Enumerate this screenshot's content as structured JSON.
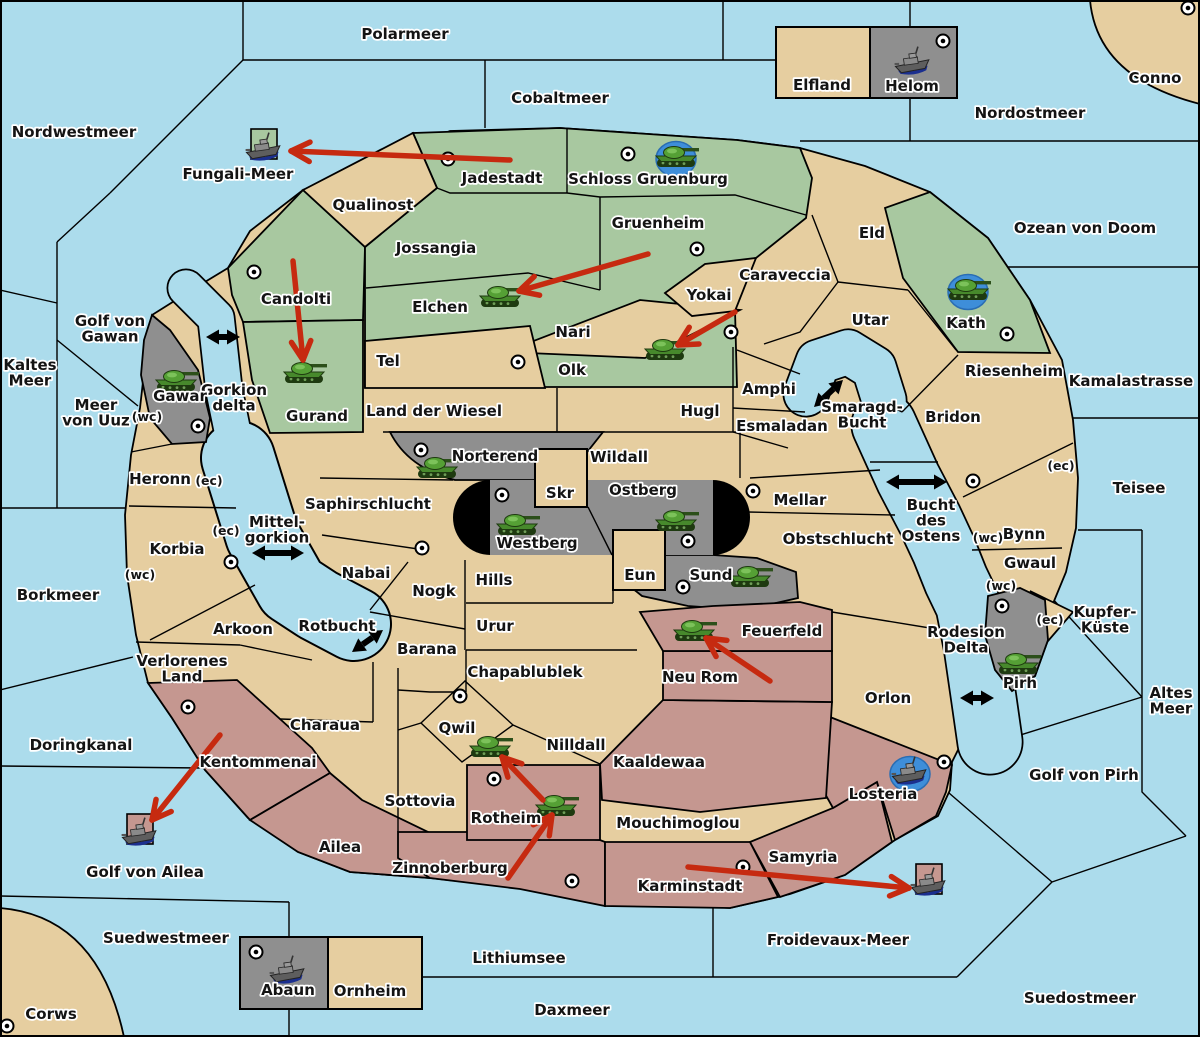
{
  "map_name": "Froidevaux wargame map",
  "palette": {
    "sea": "#ACDCEC",
    "land_tan": "#E6CEA0",
    "land_green": "#A8C8A0",
    "land_gray": "#8F8F8F",
    "land_pink": "#C59790",
    "order_red": "#C62A10",
    "unit_blue_backdrop": "#3E8ED9",
    "line_black": "#000000"
  },
  "labels": [
    {
      "id": "polarmeer",
      "text": "Polarmeer",
      "x": 405,
      "y": 39
    },
    {
      "id": "cobaltmeer",
      "text": "Cobaltmeer",
      "x": 560,
      "y": 103
    },
    {
      "id": "nordwestmeer",
      "text": "Nordwestmeer",
      "x": 74,
      "y": 137
    },
    {
      "id": "nordostmeer",
      "text": "Nordostmeer",
      "x": 1030,
      "y": 118
    },
    {
      "id": "conno",
      "text": "Conno",
      "x": 1155,
      "y": 83
    },
    {
      "id": "ozean-von-doom",
      "text": "Ozean von Doom",
      "x": 1085,
      "y": 233
    },
    {
      "id": "kamalastrasse",
      "text": "Kamalastrasse",
      "x": 1131,
      "y": 386
    },
    {
      "id": "teisee",
      "text": "Teisee",
      "x": 1139,
      "y": 493
    },
    {
      "id": "kaltes-meer",
      "lines": [
        "Kaltes",
        "Meer"
      ],
      "x": 30,
      "y": 370
    },
    {
      "id": "golf-von-gawan",
      "lines": [
        "Golf von",
        "Gawan"
      ],
      "x": 110,
      "y": 326
    },
    {
      "id": "meer-von-uuz",
      "lines": [
        "Meer",
        "von Uuz"
      ],
      "x": 96,
      "y": 410
    },
    {
      "id": "fungali-meer",
      "text": "Fungali-Meer",
      "x": 238,
      "y": 179
    },
    {
      "id": "gorkion-delta",
      "lines": [
        "Gorkion",
        "delta"
      ],
      "x": 234,
      "y": 395
    },
    {
      "id": "mittel-gorkion",
      "lines": [
        "Mittel-",
        "gorkion"
      ],
      "x": 277,
      "y": 527
    },
    {
      "id": "borkmeer",
      "text": "Borkmeer",
      "x": 58,
      "y": 600
    },
    {
      "id": "doringkanal",
      "text": "Doringkanal",
      "x": 81,
      "y": 750
    },
    {
      "id": "rotbucht",
      "text": "Rotbucht",
      "x": 337,
      "y": 631
    },
    {
      "id": "smaragd-bucht",
      "lines": [
        "Smaragd-",
        "Bucht"
      ],
      "x": 862,
      "y": 412
    },
    {
      "id": "bucht-des-ostens",
      "lines": [
        "Bucht",
        "des",
        "Ostens"
      ],
      "x": 931,
      "y": 510
    },
    {
      "id": "rodesion-delta",
      "lines": [
        "Rodesion",
        "Delta"
      ],
      "x": 966,
      "y": 637
    },
    {
      "id": "golf-von-ailea",
      "text": "Golf von Ailea",
      "x": 145,
      "y": 877
    },
    {
      "id": "suedwestmeer",
      "text": "Suedwestmeer",
      "x": 166,
      "y": 943
    },
    {
      "id": "lithiumsee",
      "text": "Lithiumsee",
      "x": 519,
      "y": 963
    },
    {
      "id": "daxmeer",
      "text": "Daxmeer",
      "x": 572,
      "y": 1015
    },
    {
      "id": "froidevaux-meer",
      "text": "Froidevaux-Meer",
      "x": 838,
      "y": 945
    },
    {
      "id": "suedostmeer",
      "text": "Suedostmeer",
      "x": 1080,
      "y": 1003
    },
    {
      "id": "golf-von-pirh",
      "text": "Golf von Pirh",
      "x": 1084,
      "y": 780
    },
    {
      "id": "altes-meer",
      "lines": [
        "Altes",
        "Meer"
      ],
      "x": 1171,
      "y": 698
    },
    {
      "id": "kupfer-kueste",
      "lines": [
        "Kupfer-",
        "Küste"
      ],
      "x": 1105,
      "y": 617
    },
    {
      "id": "corws",
      "text": "Corws",
      "x": 51,
      "y": 1019
    },
    {
      "id": "elfland",
      "text": "Elfland",
      "x": 822,
      "y": 90
    },
    {
      "id": "helom",
      "text": "Helom",
      "x": 912,
      "y": 91
    },
    {
      "id": "jadestadt",
      "text": "Jadestadt",
      "x": 502,
      "y": 183
    },
    {
      "id": "schloss-gruenburg",
      "text": "Schloss Gruenburg",
      "x": 648,
      "y": 184
    },
    {
      "id": "qualinost",
      "text": "Qualinost",
      "x": 373,
      "y": 210
    },
    {
      "id": "jossangia",
      "text": "Jossangia",
      "x": 436,
      "y": 253
    },
    {
      "id": "gruenheim",
      "text": "Gruenheim",
      "x": 658,
      "y": 228
    },
    {
      "id": "eld",
      "text": "Eld",
      "x": 872,
      "y": 238
    },
    {
      "id": "candolti",
      "text": "Candolti",
      "x": 296,
      "y": 304
    },
    {
      "id": "caraveccia",
      "text": "Caraveccia",
      "x": 785,
      "y": 280
    },
    {
      "id": "yokai",
      "text": "Yokai",
      "x": 709,
      "y": 300
    },
    {
      "id": "elchen",
      "text": "Elchen",
      "x": 440,
      "y": 312
    },
    {
      "id": "utar",
      "text": "Utar",
      "x": 870,
      "y": 325
    },
    {
      "id": "kath",
      "text": "Kath",
      "x": 966,
      "y": 328
    },
    {
      "id": "nari",
      "text": "Nari",
      "x": 573,
      "y": 337
    },
    {
      "id": "tel",
      "text": "Tel",
      "x": 388,
      "y": 366
    },
    {
      "id": "olk",
      "text": "Olk",
      "x": 572,
      "y": 375
    },
    {
      "id": "riesenheim",
      "text": "Riesenheim",
      "x": 1014,
      "y": 376
    },
    {
      "id": "gawar",
      "text": "Gawar",
      "x": 180,
      "y": 401
    },
    {
      "id": "gurand",
      "text": "Gurand",
      "x": 317,
      "y": 421
    },
    {
      "id": "land-der-wiesel",
      "text": "Land der Wiesel",
      "x": 434,
      "y": 416
    },
    {
      "id": "hugl",
      "text": "Hugl",
      "x": 700,
      "y": 416
    },
    {
      "id": "amphi",
      "text": "Amphi",
      "x": 769,
      "y": 394
    },
    {
      "id": "esmaladan",
      "text": "Esmaladan",
      "x": 782,
      "y": 431
    },
    {
      "id": "bridon",
      "text": "Bridon",
      "x": 953,
      "y": 422
    },
    {
      "id": "norterend",
      "text": "Norterend",
      "x": 495,
      "y": 461
    },
    {
      "id": "wildall",
      "text": "Wildall",
      "x": 619,
      "y": 462
    },
    {
      "id": "heronn",
      "text": "Heronn",
      "x": 160,
      "y": 484
    },
    {
      "id": "skr",
      "text": "Skr",
      "x": 560,
      "y": 498
    },
    {
      "id": "ostberg",
      "text": "Ostberg",
      "x": 643,
      "y": 495
    },
    {
      "id": "mellar",
      "text": "Mellar",
      "x": 800,
      "y": 505
    },
    {
      "id": "saphirschlucht",
      "text": "Saphirschlucht",
      "x": 368,
      "y": 509
    },
    {
      "id": "westberg",
      "text": "Westberg",
      "x": 537,
      "y": 548
    },
    {
      "id": "bynn",
      "text": "Bynn",
      "x": 1024,
      "y": 539
    },
    {
      "id": "korbia",
      "text": "Korbia",
      "x": 177,
      "y": 554
    },
    {
      "id": "obstschlucht",
      "text": "Obstschlucht",
      "x": 838,
      "y": 544
    },
    {
      "id": "nabai",
      "text": "Nabai",
      "x": 366,
      "y": 578
    },
    {
      "id": "eun",
      "text": "Eun",
      "x": 640,
      "y": 580
    },
    {
      "id": "sund",
      "text": "Sund",
      "x": 711,
      "y": 580
    },
    {
      "id": "gwaul",
      "text": "Gwaul",
      "x": 1030,
      "y": 568
    },
    {
      "id": "hills",
      "text": "Hills",
      "x": 494,
      "y": 585
    },
    {
      "id": "nogk",
      "text": "Nogk",
      "x": 434,
      "y": 596
    },
    {
      "id": "urur",
      "text": "Urur",
      "x": 495,
      "y": 631
    },
    {
      "id": "feuerfeld",
      "text": "Feuerfeld",
      "x": 782,
      "y": 636
    },
    {
      "id": "arkoon",
      "text": "Arkoon",
      "x": 243,
      "y": 634
    },
    {
      "id": "barana",
      "text": "Barana",
      "x": 427,
      "y": 654
    },
    {
      "id": "pirh",
      "text": "Pirh",
      "x": 1020,
      "y": 688
    },
    {
      "id": "verlorenes-land",
      "lines": [
        "Verlorenes",
        "Land"
      ],
      "x": 182,
      "y": 666
    },
    {
      "id": "chapablublek",
      "text": "Chapablublek",
      "x": 525,
      "y": 677
    },
    {
      "id": "neu-rom",
      "text": "Neu Rom",
      "x": 700,
      "y": 682
    },
    {
      "id": "orlon",
      "text": "Orlon",
      "x": 888,
      "y": 703
    },
    {
      "id": "charaua",
      "text": "Charaua",
      "x": 325,
      "y": 730
    },
    {
      "id": "kentommenai",
      "text": "Kentommenai",
      "x": 258,
      "y": 767
    },
    {
      "id": "qwil",
      "text": "Qwil",
      "x": 457,
      "y": 733
    },
    {
      "id": "nilldall",
      "text": "Nilldall",
      "x": 576,
      "y": 750
    },
    {
      "id": "kaaldewaa",
      "text": "Kaaldewaa",
      "x": 659,
      "y": 767
    },
    {
      "id": "losteria",
      "text": "Losteria",
      "x": 883,
      "y": 799
    },
    {
      "id": "sottovia",
      "text": "Sottovia",
      "x": 420,
      "y": 806
    },
    {
      "id": "rotheim",
      "text": "Rotheim",
      "x": 506,
      "y": 823
    },
    {
      "id": "mouchimoglou",
      "text": "Mouchimoglou",
      "x": 678,
      "y": 828
    },
    {
      "id": "ailea",
      "text": "Ailea",
      "x": 340,
      "y": 852
    },
    {
      "id": "zinnoberburg",
      "text": "Zinnoberburg",
      "x": 450,
      "y": 873
    },
    {
      "id": "samyria",
      "text": "Samyria",
      "x": 803,
      "y": 862
    },
    {
      "id": "karminstadt",
      "text": "Karminstadt",
      "x": 690,
      "y": 891
    },
    {
      "id": "abaun",
      "text": "Abaun",
      "x": 288,
      "y": 995
    },
    {
      "id": "ornheim",
      "text": "Ornheim",
      "x": 370,
      "y": 996
    },
    {
      "id": "uuz-wc",
      "text": "(wc)",
      "x": 147,
      "y": 421,
      "kind": "tag"
    },
    {
      "id": "heronn-ec",
      "text": "(ec)",
      "x": 209,
      "y": 485,
      "kind": "tag"
    },
    {
      "id": "korbia-ec",
      "text": "(ec)",
      "x": 226,
      "y": 535,
      "kind": "tag"
    },
    {
      "id": "korbia-wc",
      "text": "(wc)",
      "x": 140,
      "y": 579,
      "kind": "tag"
    },
    {
      "id": "bynn-ec",
      "text": "(ec)",
      "x": 1061,
      "y": 470,
      "kind": "tag"
    },
    {
      "id": "bynn-wc",
      "text": "(wc)",
      "x": 988,
      "y": 542,
      "kind": "tag"
    },
    {
      "id": "gwaul-wc",
      "text": "(wc)",
      "x": 1001,
      "y": 590,
      "kind": "tag"
    },
    {
      "id": "pirh-ec",
      "text": "(ec)",
      "x": 1050,
      "y": 624,
      "kind": "tag"
    }
  ],
  "supply_centers": [
    [
      448,
      159
    ],
    [
      628,
      154
    ],
    [
      697,
      249
    ],
    [
      254,
      272
    ],
    [
      1188,
      8
    ],
    [
      943,
      41
    ],
    [
      518,
      362
    ],
    [
      731,
      332
    ],
    [
      1007,
      334
    ],
    [
      198,
      426
    ],
    [
      421,
      450
    ],
    [
      502,
      495
    ],
    [
      688,
      541
    ],
    [
      753,
      491
    ],
    [
      683,
      587
    ],
    [
      422,
      548
    ],
    [
      231,
      562
    ],
    [
      188,
      707
    ],
    [
      973,
      481
    ],
    [
      1002,
      606
    ],
    [
      460,
      696
    ],
    [
      494,
      779
    ],
    [
      572,
      881
    ],
    [
      743,
      867
    ],
    [
      944,
      762
    ],
    [
      256,
      952
    ],
    [
      7,
      1026
    ]
  ],
  "units": [
    {
      "type": "army",
      "territory": "elchen",
      "x": 500,
      "y": 297,
      "backdrop": "none"
    },
    {
      "type": "army",
      "territory": "olk",
      "x": 665,
      "y": 350,
      "backdrop": "none"
    },
    {
      "type": "army",
      "territory": "gurand",
      "x": 304,
      "y": 373,
      "backdrop": "none"
    },
    {
      "type": "army",
      "territory": "gawar",
      "x": 176,
      "y": 381,
      "backdrop": "none"
    },
    {
      "type": "army",
      "territory": "norterend",
      "x": 437,
      "y": 468,
      "backdrop": "none"
    },
    {
      "type": "army",
      "territory": "westberg",
      "x": 517,
      "y": 525,
      "backdrop": "none"
    },
    {
      "type": "army",
      "territory": "ostberg",
      "x": 676,
      "y": 521,
      "backdrop": "none"
    },
    {
      "type": "army",
      "territory": "sund",
      "x": 750,
      "y": 577,
      "backdrop": "none"
    },
    {
      "type": "army",
      "territory": "feuerfeld",
      "x": 694,
      "y": 631,
      "backdrop": "none"
    },
    {
      "type": "army",
      "territory": "qwil",
      "x": 490,
      "y": 747,
      "backdrop": "none"
    },
    {
      "type": "army",
      "territory": "rotheim",
      "x": 556,
      "y": 806,
      "backdrop": "none"
    },
    {
      "type": "army",
      "territory": "pirh",
      "x": 1018,
      "y": 664,
      "backdrop": "none"
    },
    {
      "type": "army",
      "territory": "kath",
      "x": 968,
      "y": 290,
      "backdrop": "blue"
    },
    {
      "type": "army",
      "territory": "schloss-gruenburg",
      "x": 676,
      "y": 157,
      "backdrop": "blue"
    },
    {
      "type": "fleet",
      "territory": "fungali-meer",
      "x": 264,
      "y": 148,
      "backdrop": "green-square"
    },
    {
      "type": "fleet",
      "territory": "helom",
      "x": 913,
      "y": 62,
      "backdrop": "none"
    },
    {
      "type": "fleet",
      "territory": "abaun",
      "x": 288,
      "y": 971,
      "backdrop": "none"
    },
    {
      "type": "fleet",
      "territory": "golf-von-ailea",
      "x": 140,
      "y": 833,
      "backdrop": "pink-square"
    },
    {
      "type": "fleet",
      "territory": "froidevaux-meer",
      "x": 929,
      "y": 883,
      "backdrop": "pink-square"
    },
    {
      "type": "fleet",
      "territory": "losteria",
      "x": 910,
      "y": 772,
      "backdrop": "blue"
    }
  ],
  "orders": {
    "moves": [
      {
        "from": [
          510,
          160
        ],
        "to": [
          291,
          151
        ]
      },
      {
        "from": [
          648,
          254
        ],
        "to": [
          519,
          291
        ]
      },
      {
        "from": [
          293,
          261
        ],
        "to": [
          303,
          360
        ]
      },
      {
        "from": [
          735,
          312
        ],
        "to": [
          678,
          345
        ]
      },
      {
        "from": [
          770,
          681
        ],
        "to": [
          706,
          638
        ]
      },
      {
        "from": [
          508,
          878
        ],
        "to": [
          552,
          815
        ]
      },
      {
        "from": [
          543,
          800
        ],
        "to": [
          502,
          757
        ]
      },
      {
        "from": [
          220,
          735
        ],
        "to": [
          152,
          820
        ]
      },
      {
        "from": [
          688,
          867
        ],
        "to": [
          909,
          888
        ]
      }
    ],
    "straits": [
      {
        "from": [
          206,
          337
        ],
        "to": [
          240,
          337
        ]
      },
      {
        "from": [
          252,
          553
        ],
        "to": [
          304,
          553
        ]
      },
      {
        "from": [
          814,
          407
        ],
        "to": [
          843,
          380
        ]
      },
      {
        "from": [
          886,
          482
        ],
        "to": [
          947,
          482
        ]
      },
      {
        "from": [
          352,
          652
        ],
        "to": [
          383,
          630
        ]
      },
      {
        "from": [
          960,
          698
        ],
        "to": [
          994,
          698
        ]
      }
    ]
  }
}
